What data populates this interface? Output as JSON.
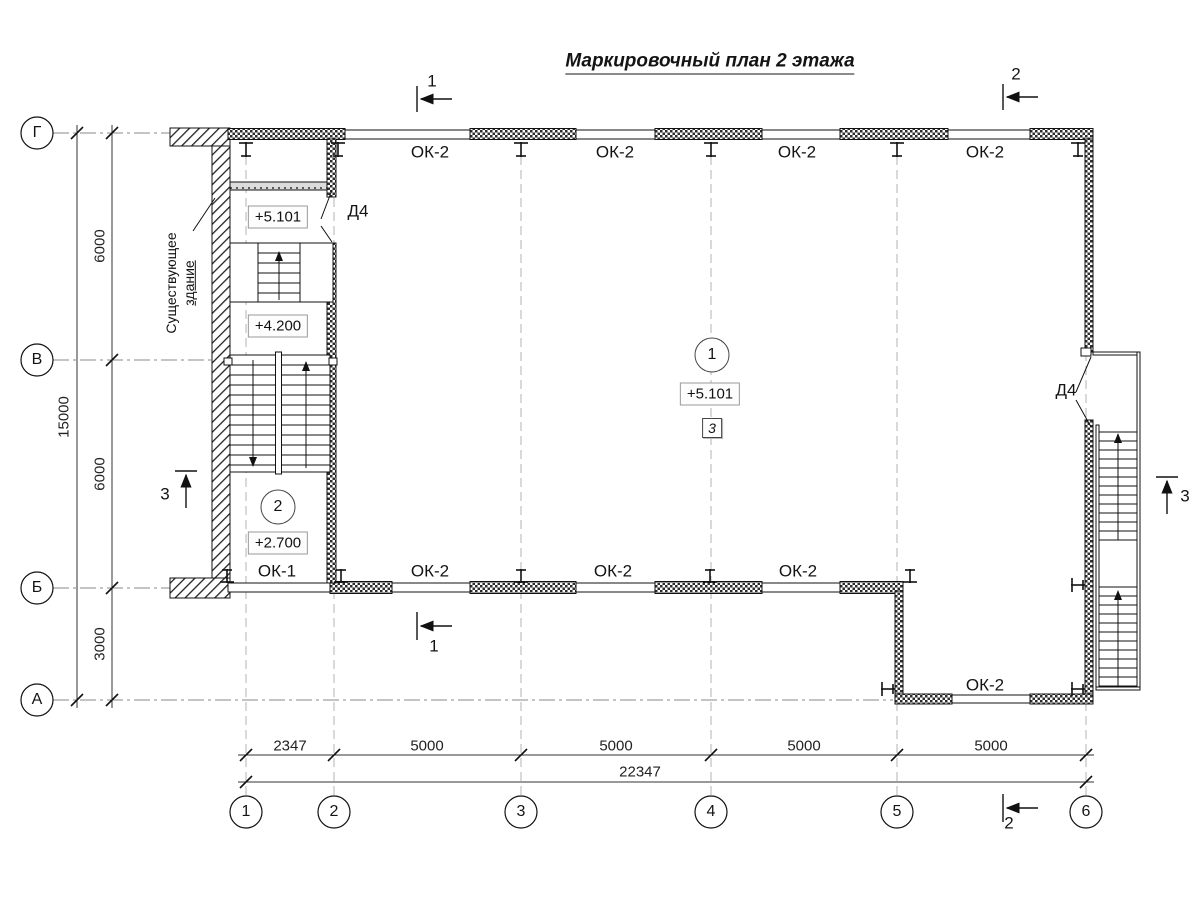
{
  "title": "Маркировочный план 2 этажа",
  "plan": {
    "existing_building_note": {
      "line1": "Существующее",
      "line2": "здание"
    },
    "window_marks": {
      "ok2": "ОК-2",
      "ok1": "ОК-1"
    },
    "door_mark": "Д4",
    "elevations": {
      "upper_landing": "+5.101",
      "mid_landing": "+4.200",
      "hall": "+5.101",
      "lower_landing": "+2.700"
    },
    "room_numbers": {
      "hall": "1",
      "stairwell": "2"
    },
    "node_ref": "3"
  },
  "axes": {
    "columns": [
      "1",
      "2",
      "3",
      "4",
      "5",
      "6"
    ],
    "rows": [
      "Г",
      "В",
      "Б",
      "А"
    ]
  },
  "dimensions": {
    "vertical": {
      "g_v": "6000",
      "v_b": "6000",
      "b_a": "3000",
      "total": "15000"
    },
    "horizontal": {
      "d12": "2347",
      "d23": "5000",
      "d34": "5000",
      "d45": "5000",
      "d56": "5000",
      "total": "22347"
    }
  },
  "section_marks": {
    "s1": "1",
    "s2": "2",
    "s3": "3"
  }
}
